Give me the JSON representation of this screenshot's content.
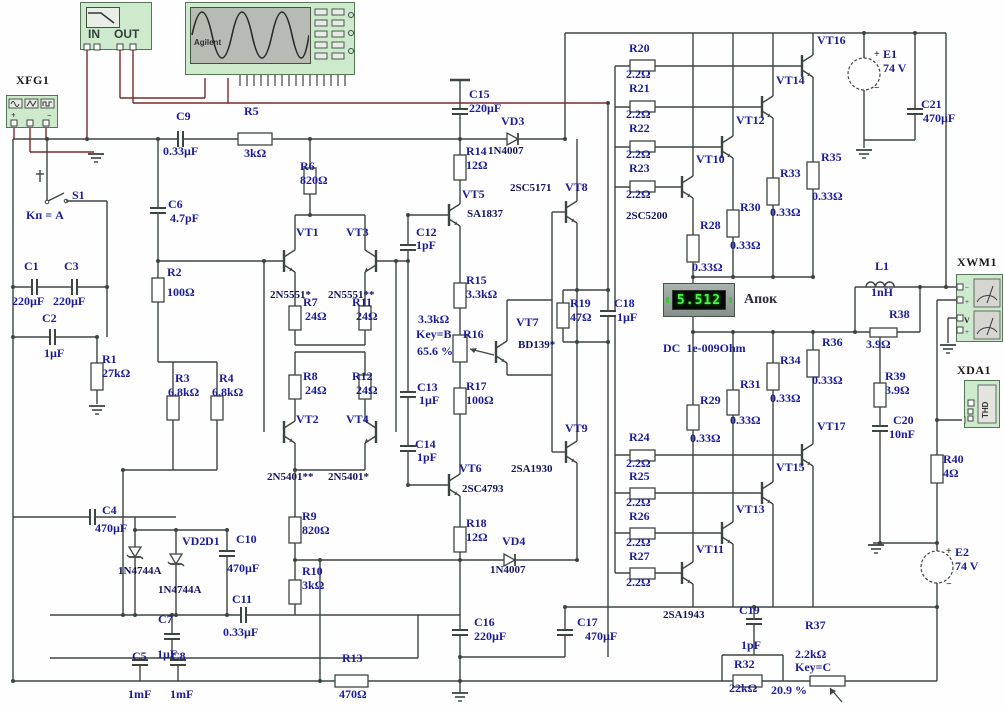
{
  "display": {
    "value": "5.512",
    "meter_name": "Апок",
    "mode": "DC  1e-009Ohm"
  },
  "instruments": {
    "limiter_in": "IN",
    "limiter_out": "OUT",
    "scope_brand": "Agilent",
    "analyzer_mode": "THD"
  },
  "colors": {
    "wire": "#3d4540",
    "probe_wire": "#7a2a2a",
    "label": "#1c1c96",
    "panel": "#cdeacd",
    "digit": "#49f549"
  },
  "labels": [
    {
      "t": "XFG1",
      "x": 16,
      "y": 74,
      "c": "k"
    },
    {
      "t": "S1",
      "x": 72,
      "y": 189
    },
    {
      "t": "Kп = A",
      "x": 26,
      "y": 209
    },
    {
      "t": "C1",
      "x": 24,
      "y": 260
    },
    {
      "t": "220µF",
      "x": 12,
      "y": 295
    },
    {
      "t": "C3",
      "x": 64,
      "y": 260
    },
    {
      "t": "220µF",
      "x": 53,
      "y": 295
    },
    {
      "t": "C2",
      "x": 42,
      "y": 312
    },
    {
      "t": "1µF",
      "x": 44,
      "y": 347
    },
    {
      "t": "R1",
      "x": 102,
      "y": 353
    },
    {
      "t": "27kΩ",
      "x": 102,
      "y": 367
    },
    {
      "t": "C9",
      "x": 176,
      "y": 110
    },
    {
      "t": "0.33µF",
      "x": 163,
      "y": 145
    },
    {
      "t": "R5",
      "x": 244,
      "y": 105
    },
    {
      "t": "3kΩ",
      "x": 244,
      "y": 147
    },
    {
      "t": "C6",
      "x": 168,
      "y": 198
    },
    {
      "t": "4.7pF",
      "x": 170,
      "y": 212
    },
    {
      "t": "R2",
      "x": 167,
      "y": 266
    },
    {
      "t": "100Ω",
      "x": 167,
      "y": 286
    },
    {
      "t": "R3",
      "x": 175,
      "y": 372
    },
    {
      "t": "6.8kΩ",
      "x": 168,
      "y": 386
    },
    {
      "t": "R4",
      "x": 219,
      "y": 372
    },
    {
      "t": "6.8kΩ",
      "x": 212,
      "y": 386
    },
    {
      "t": "R6",
      "x": 300,
      "y": 160
    },
    {
      "t": "820Ω",
      "x": 300,
      "y": 174
    },
    {
      "t": "VT1",
      "x": 296,
      "y": 226
    },
    {
      "t": "VT3",
      "x": 346,
      "y": 226
    },
    {
      "t": "2N5551*",
      "x": 270,
      "y": 290,
      "c": "pt"
    },
    {
      "t": "2N5551**",
      "x": 328,
      "y": 290,
      "c": "pt"
    },
    {
      "t": "R7",
      "x": 303,
      "y": 296
    },
    {
      "t": "24Ω",
      "x": 305,
      "y": 310
    },
    {
      "t": "R11",
      "x": 352,
      "y": 296
    },
    {
      "t": "24Ω",
      "x": 356,
      "y": 310
    },
    {
      "t": "R8",
      "x": 303,
      "y": 370
    },
    {
      "t": "24Ω",
      "x": 305,
      "y": 384
    },
    {
      "t": "R12",
      "x": 352,
      "y": 370
    },
    {
      "t": "24Ω",
      "x": 356,
      "y": 384
    },
    {
      "t": "VT2",
      "x": 296,
      "y": 413
    },
    {
      "t": "VT4",
      "x": 346,
      "y": 413
    },
    {
      "t": "2N5401**",
      "x": 267,
      "y": 472,
      "c": "pt"
    },
    {
      "t": "2N5401*",
      "x": 328,
      "y": 472,
      "c": "pt"
    },
    {
      "t": "C12",
      "x": 416,
      "y": 226
    },
    {
      "t": "1pF",
      "x": 416,
      "y": 239
    },
    {
      "t": "C15",
      "x": 469,
      "y": 88
    },
    {
      "t": "220µF",
      "x": 469,
      "y": 102
    },
    {
      "t": "VD3",
      "x": 501,
      "y": 115
    },
    {
      "t": "1N4007",
      "x": 488,
      "y": 146,
      "c": "pt"
    },
    {
      "t": "R14",
      "x": 466,
      "y": 145
    },
    {
      "t": "12Ω",
      "x": 466,
      "y": 159
    },
    {
      "t": "VT5",
      "x": 462,
      "y": 188
    },
    {
      "t": "SA1837",
      "x": 467,
      "y": 209,
      "c": "pt"
    },
    {
      "t": "2SC5171",
      "x": 510,
      "y": 183,
      "c": "pt"
    },
    {
      "t": "VT8",
      "x": 565,
      "y": 181
    },
    {
      "t": "R15",
      "x": 466,
      "y": 274
    },
    {
      "t": "3.3kΩ",
      "x": 466,
      "y": 288
    },
    {
      "t": "3.3kΩ",
      "x": 418,
      "y": 313
    },
    {
      "t": "Key=B",
      "x": 416,
      "y": 328
    },
    {
      "t": "65.6 %",
      "x": 417,
      "y": 345
    },
    {
      "t": "R16",
      "x": 463,
      "y": 328
    },
    {
      "t": "VT7",
      "x": 516,
      "y": 316
    },
    {
      "t": "BD139*",
      "x": 518,
      "y": 340,
      "c": "pt"
    },
    {
      "t": "C13",
      "x": 417,
      "y": 381
    },
    {
      "t": "1µF",
      "x": 419,
      "y": 394
    },
    {
      "t": "R17",
      "x": 466,
      "y": 380
    },
    {
      "t": "100Ω",
      "x": 466,
      "y": 394
    },
    {
      "t": "C14",
      "x": 415,
      "y": 438
    },
    {
      "t": "1pF",
      "x": 417,
      "y": 451
    },
    {
      "t": "VT6",
      "x": 459,
      "y": 462
    },
    {
      "t": "2SC4793",
      "x": 462,
      "y": 484,
      "c": "pt"
    },
    {
      "t": "VT9",
      "x": 565,
      "y": 422
    },
    {
      "t": "2SA1930",
      "x": 511,
      "y": 464,
      "c": "pt"
    },
    {
      "t": "R18",
      "x": 466,
      "y": 517
    },
    {
      "t": "12Ω",
      "x": 466,
      "y": 531
    },
    {
      "t": "VD4",
      "x": 502,
      "y": 535
    },
    {
      "t": "1N4007",
      "x": 490,
      "y": 565,
      "c": "pt"
    },
    {
      "t": "R19",
      "x": 570,
      "y": 297
    },
    {
      "t": "47Ω",
      "x": 570,
      "y": 311
    },
    {
      "t": "C18",
      "x": 614,
      "y": 297
    },
    {
      "t": "1µF",
      "x": 617,
      "y": 311
    },
    {
      "t": "C16",
      "x": 474,
      "y": 616
    },
    {
      "t": "220µF",
      "x": 474,
      "y": 630
    },
    {
      "t": "C17",
      "x": 577,
      "y": 616
    },
    {
      "t": "470µF",
      "x": 585,
      "y": 630
    },
    {
      "t": "R13",
      "x": 342,
      "y": 652
    },
    {
      "t": "470Ω",
      "x": 339,
      "y": 688
    },
    {
      "t": "C5",
      "x": 132,
      "y": 650
    },
    {
      "t": "1mF",
      "x": 128,
      "y": 688
    },
    {
      "t": "C8",
      "x": 171,
      "y": 650
    },
    {
      "t": "1mF",
      "x": 170,
      "y": 688
    },
    {
      "t": "C7",
      "x": 158,
      "y": 613
    },
    {
      "t": "1µF",
      "x": 157,
      "y": 648
    },
    {
      "t": "C11",
      "x": 232,
      "y": 593
    },
    {
      "t": "0.33µF",
      "x": 223,
      "y": 626
    },
    {
      "t": "C10",
      "x": 236,
      "y": 533
    },
    {
      "t": "470µF",
      "x": 227,
      "y": 562
    },
    {
      "t": "VD2",
      "x": 182,
      "y": 535
    },
    {
      "t": "D1",
      "x": 205,
      "y": 535
    },
    {
      "t": "1N4744A",
      "x": 118,
      "y": 566,
      "c": "pt"
    },
    {
      "t": "1N4744A",
      "x": 158,
      "y": 585,
      "c": "pt"
    },
    {
      "t": "C4",
      "x": 102,
      "y": 504
    },
    {
      "t": "470µF",
      "x": 95,
      "y": 522
    },
    {
      "t": "R9",
      "x": 302,
      "y": 510
    },
    {
      "t": "820Ω",
      "x": 302,
      "y": 524
    },
    {
      "t": "R10",
      "x": 302,
      "y": 565
    },
    {
      "t": "3kΩ",
      "x": 302,
      "y": 579
    },
    {
      "t": "R20",
      "x": 629,
      "y": 42
    },
    {
      "t": "2.2Ω",
      "x": 626,
      "y": 68
    },
    {
      "t": "R21",
      "x": 629,
      "y": 82
    },
    {
      "t": "2.2Ω",
      "x": 626,
      "y": 108
    },
    {
      "t": "R22",
      "x": 629,
      "y": 122
    },
    {
      "t": "2.2Ω",
      "x": 626,
      "y": 148
    },
    {
      "t": "R23",
      "x": 629,
      "y": 162
    },
    {
      "t": "2.2Ω",
      "x": 626,
      "y": 188
    },
    {
      "t": "2SC5200",
      "x": 626,
      "y": 211,
      "c": "pt"
    },
    {
      "t": "VT10",
      "x": 696,
      "y": 153
    },
    {
      "t": "VT12",
      "x": 736,
      "y": 114
    },
    {
      "t": "VT14",
      "x": 776,
      "y": 74
    },
    {
      "t": "VT16",
      "x": 817,
      "y": 34
    },
    {
      "t": "R28",
      "x": 700,
      "y": 219
    },
    {
      "t": "0.33Ω",
      "x": 692,
      "y": 261
    },
    {
      "t": "R30",
      "x": 740,
      "y": 201
    },
    {
      "t": "0.33Ω",
      "x": 730,
      "y": 239
    },
    {
      "t": "R33",
      "x": 780,
      "y": 167
    },
    {
      "t": "0.33Ω",
      "x": 770,
      "y": 206
    },
    {
      "t": "R35",
      "x": 821,
      "y": 151
    },
    {
      "t": "0.33Ω",
      "x": 812,
      "y": 190
    },
    {
      "t": "+",
      "x": 874,
      "y": 50,
      "c": "sg"
    },
    {
      "t": "E1",
      "x": 883,
      "y": 48
    },
    {
      "t": "74 V",
      "x": 883,
      "y": 62
    },
    {
      "t": "−",
      "x": 874,
      "y": 84,
      "c": "sg"
    },
    {
      "t": "C21",
      "x": 921,
      "y": 98
    },
    {
      "t": "470µF",
      "x": 923,
      "y": 112
    },
    {
      "t": "L1",
      "x": 875,
      "y": 260
    },
    {
      "t": "1nH",
      "x": 871,
      "y": 286
    },
    {
      "t": "R38",
      "x": 889,
      "y": 308
    },
    {
      "t": "3.9Ω",
      "x": 866,
      "y": 338
    },
    {
      "t": "XWM1",
      "x": 957,
      "y": 256,
      "c": "k"
    },
    {
      "t": "XDA1",
      "x": 957,
      "y": 364,
      "c": "k"
    },
    {
      "t": "R39",
      "x": 885,
      "y": 370
    },
    {
      "t": "3.9Ω",
      "x": 885,
      "y": 384
    },
    {
      "t": "C20",
      "x": 893,
      "y": 414
    },
    {
      "t": "10nF",
      "x": 889,
      "y": 428
    },
    {
      "t": "R40",
      "x": 943,
      "y": 453
    },
    {
      "t": "4Ω",
      "x": 943,
      "y": 467
    },
    {
      "t": "Апок",
      "x": 744,
      "y": 293,
      "c": "big"
    },
    {
      "t": "DC  1e-009Ohm",
      "x": 663,
      "y": 342
    },
    {
      "t": "R24",
      "x": 629,
      "y": 431
    },
    {
      "t": "2.2Ω",
      "x": 626,
      "y": 457
    },
    {
      "t": "R25",
      "x": 629,
      "y": 470
    },
    {
      "t": "2.2Ω",
      "x": 626,
      "y": 496
    },
    {
      "t": "R26",
      "x": 629,
      "y": 510
    },
    {
      "t": "2.2Ω",
      "x": 626,
      "y": 536
    },
    {
      "t": "R27",
      "x": 629,
      "y": 550
    },
    {
      "t": "2.2Ω",
      "x": 626,
      "y": 576
    },
    {
      "t": "2SA1943",
      "x": 663,
      "y": 610,
      "c": "pt"
    },
    {
      "t": "VT11",
      "x": 696,
      "y": 543
    },
    {
      "t": "VT13",
      "x": 736,
      "y": 503
    },
    {
      "t": "VT15",
      "x": 776,
      "y": 461
    },
    {
      "t": "VT17",
      "x": 817,
      "y": 420
    },
    {
      "t": "R29",
      "x": 700,
      "y": 394
    },
    {
      "t": "0.33Ω",
      "x": 690,
      "y": 432
    },
    {
      "t": "R31",
      "x": 740,
      "y": 378
    },
    {
      "t": "0.33Ω",
      "x": 730,
      "y": 414
    },
    {
      "t": "R34",
      "x": 780,
      "y": 354
    },
    {
      "t": "0.33Ω",
      "x": 770,
      "y": 392
    },
    {
      "t": "R36",
      "x": 822,
      "y": 336
    },
    {
      "t": "0.33Ω",
      "x": 812,
      "y": 374
    },
    {
      "t": "C19",
      "x": 739,
      "y": 604
    },
    {
      "t": "1pF",
      "x": 741,
      "y": 639
    },
    {
      "t": "R32",
      "x": 734,
      "y": 658
    },
    {
      "t": "22kΩ",
      "x": 729,
      "y": 682
    },
    {
      "t": "R37",
      "x": 805,
      "y": 619
    },
    {
      "t": "2.2kΩ",
      "x": 795,
      "y": 648
    },
    {
      "t": "Key=C",
      "x": 795,
      "y": 661
    },
    {
      "t": "20.9 %",
      "x": 771,
      "y": 684
    },
    {
      "t": "+",
      "x": 946,
      "y": 547,
      "c": "sg"
    },
    {
      "t": "E2",
      "x": 955,
      "y": 546
    },
    {
      "t": "74 V",
      "x": 955,
      "y": 560
    },
    {
      "t": "−",
      "x": 946,
      "y": 580,
      "c": "sg"
    }
  ]
}
